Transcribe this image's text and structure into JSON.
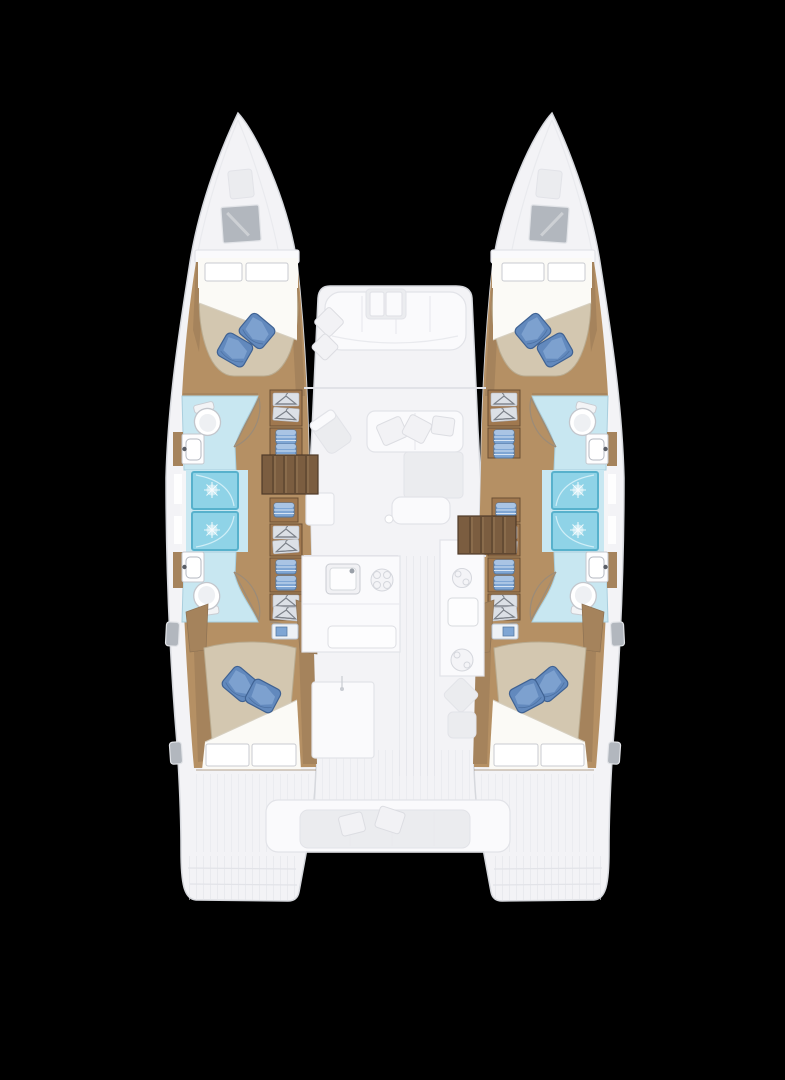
{
  "scene": {
    "type": "catamaran-floor-plan",
    "view": "top-down deck and accommodation plan",
    "background_color": "#000000"
  },
  "palette": {
    "hull_fill": "#f3f3f6",
    "hull_outline": "#d6d8dd",
    "ghost_furniture_fill": "#fafafc",
    "ghost_furniture_line": "#e2e3e8",
    "deck_shadow": "#ebecef",
    "wood_floor": "#b59064",
    "wood_trim": "#a5835c",
    "wood_dark": "#6b4f35",
    "cabinet_wood": "#a0784f",
    "stair_wood": "#7b5d40",
    "stair_line": "#4f3a28",
    "mattress_tan": "#d3c7b0",
    "mattress_edge": "#b9ab90",
    "sheet_white": "#fbfaf6",
    "pillow_blue": "#6289bd",
    "pillow_blue_light": "#93b5de",
    "pillow_blue_dark": "#3f6293",
    "bath_floor_blue": "#c8e7f1",
    "bath_floor_edge": "#a9cedd",
    "shower_blue": "#8fd3e7",
    "shower_edge": "#57b1cc",
    "fixture_white": "#ffffff",
    "fixture_outline": "#c3c6cc",
    "storage_blue": "#7fa6d4",
    "storage_blue_dark": "#54779f",
    "window_gray": "#b2b7be",
    "glyph_gray": "#7d828a"
  },
  "vessel": {
    "hulls": [
      {
        "id": "port-hull",
        "side": "left",
        "rooms": [
          {
            "name": "forward-cabin",
            "features": [
              "double-berth",
              "two-white-head-pillows",
              "two-blue-pillows",
              "wood-sole",
              "bow-window"
            ]
          },
          {
            "name": "forward-head",
            "features": [
              "toilet",
              "washbasin",
              "door-swing"
            ]
          },
          {
            "name": "shower-forward",
            "features": [
              "shower-stall"
            ]
          },
          {
            "name": "shower-aft",
            "features": [
              "shower-stall"
            ]
          },
          {
            "name": "aft-head",
            "features": [
              "toilet",
              "washbasin",
              "door-swing"
            ]
          },
          {
            "name": "companionway-corridor",
            "features": [
              "hanging-lockers",
              "linen-shelves",
              "steps"
            ]
          },
          {
            "name": "aft-cabin",
            "features": [
              "double-berth",
              "two-white-foot-pillows",
              "two-blue-pillows",
              "bedside-shelf",
              "hull-windows"
            ]
          }
        ]
      },
      {
        "id": "starboard-hull",
        "side": "right",
        "rooms": [
          {
            "name": "forward-cabin",
            "features": [
              "double-berth",
              "two-white-head-pillows",
              "two-blue-pillows",
              "wood-sole",
              "bow-window"
            ]
          },
          {
            "name": "forward-head",
            "features": [
              "toilet",
              "washbasin",
              "door-swing"
            ]
          },
          {
            "name": "shower-forward",
            "features": [
              "shower-stall"
            ]
          },
          {
            "name": "shower-aft",
            "features": [
              "shower-stall"
            ]
          },
          {
            "name": "aft-head",
            "features": [
              "toilet",
              "washbasin",
              "door-swing"
            ]
          },
          {
            "name": "companionway-corridor",
            "features": [
              "hanging-lockers",
              "linen-shelves",
              "steps"
            ]
          },
          {
            "name": "aft-cabin",
            "features": [
              "double-berth",
              "two-white-foot-pillows",
              "two-blue-pillows",
              "bedside-shelf",
              "hull-windows"
            ]
          }
        ]
      }
    ],
    "bridgedeck": {
      "areas": [
        {
          "name": "foredeck-lounge",
          "features": [
            "bench-seat",
            "two-cushions",
            "table"
          ]
        },
        {
          "name": "salon",
          "features": [
            "l-shaped-sofa",
            "chaise",
            "sofa-cushions",
            "ottoman-table",
            "nav-chair",
            "nav-desk"
          ]
        },
        {
          "name": "galley",
          "features": [
            "sink",
            "four-burner-stove",
            "second-burner",
            "counters",
            "island-unit"
          ]
        },
        {
          "name": "helm-area",
          "features": [
            "helm-seat",
            "module"
          ]
        },
        {
          "name": "cockpit",
          "features": [
            "aft-bench",
            "bench-cushions",
            "teak-floor",
            "transom-steps"
          ]
        }
      ]
    }
  }
}
